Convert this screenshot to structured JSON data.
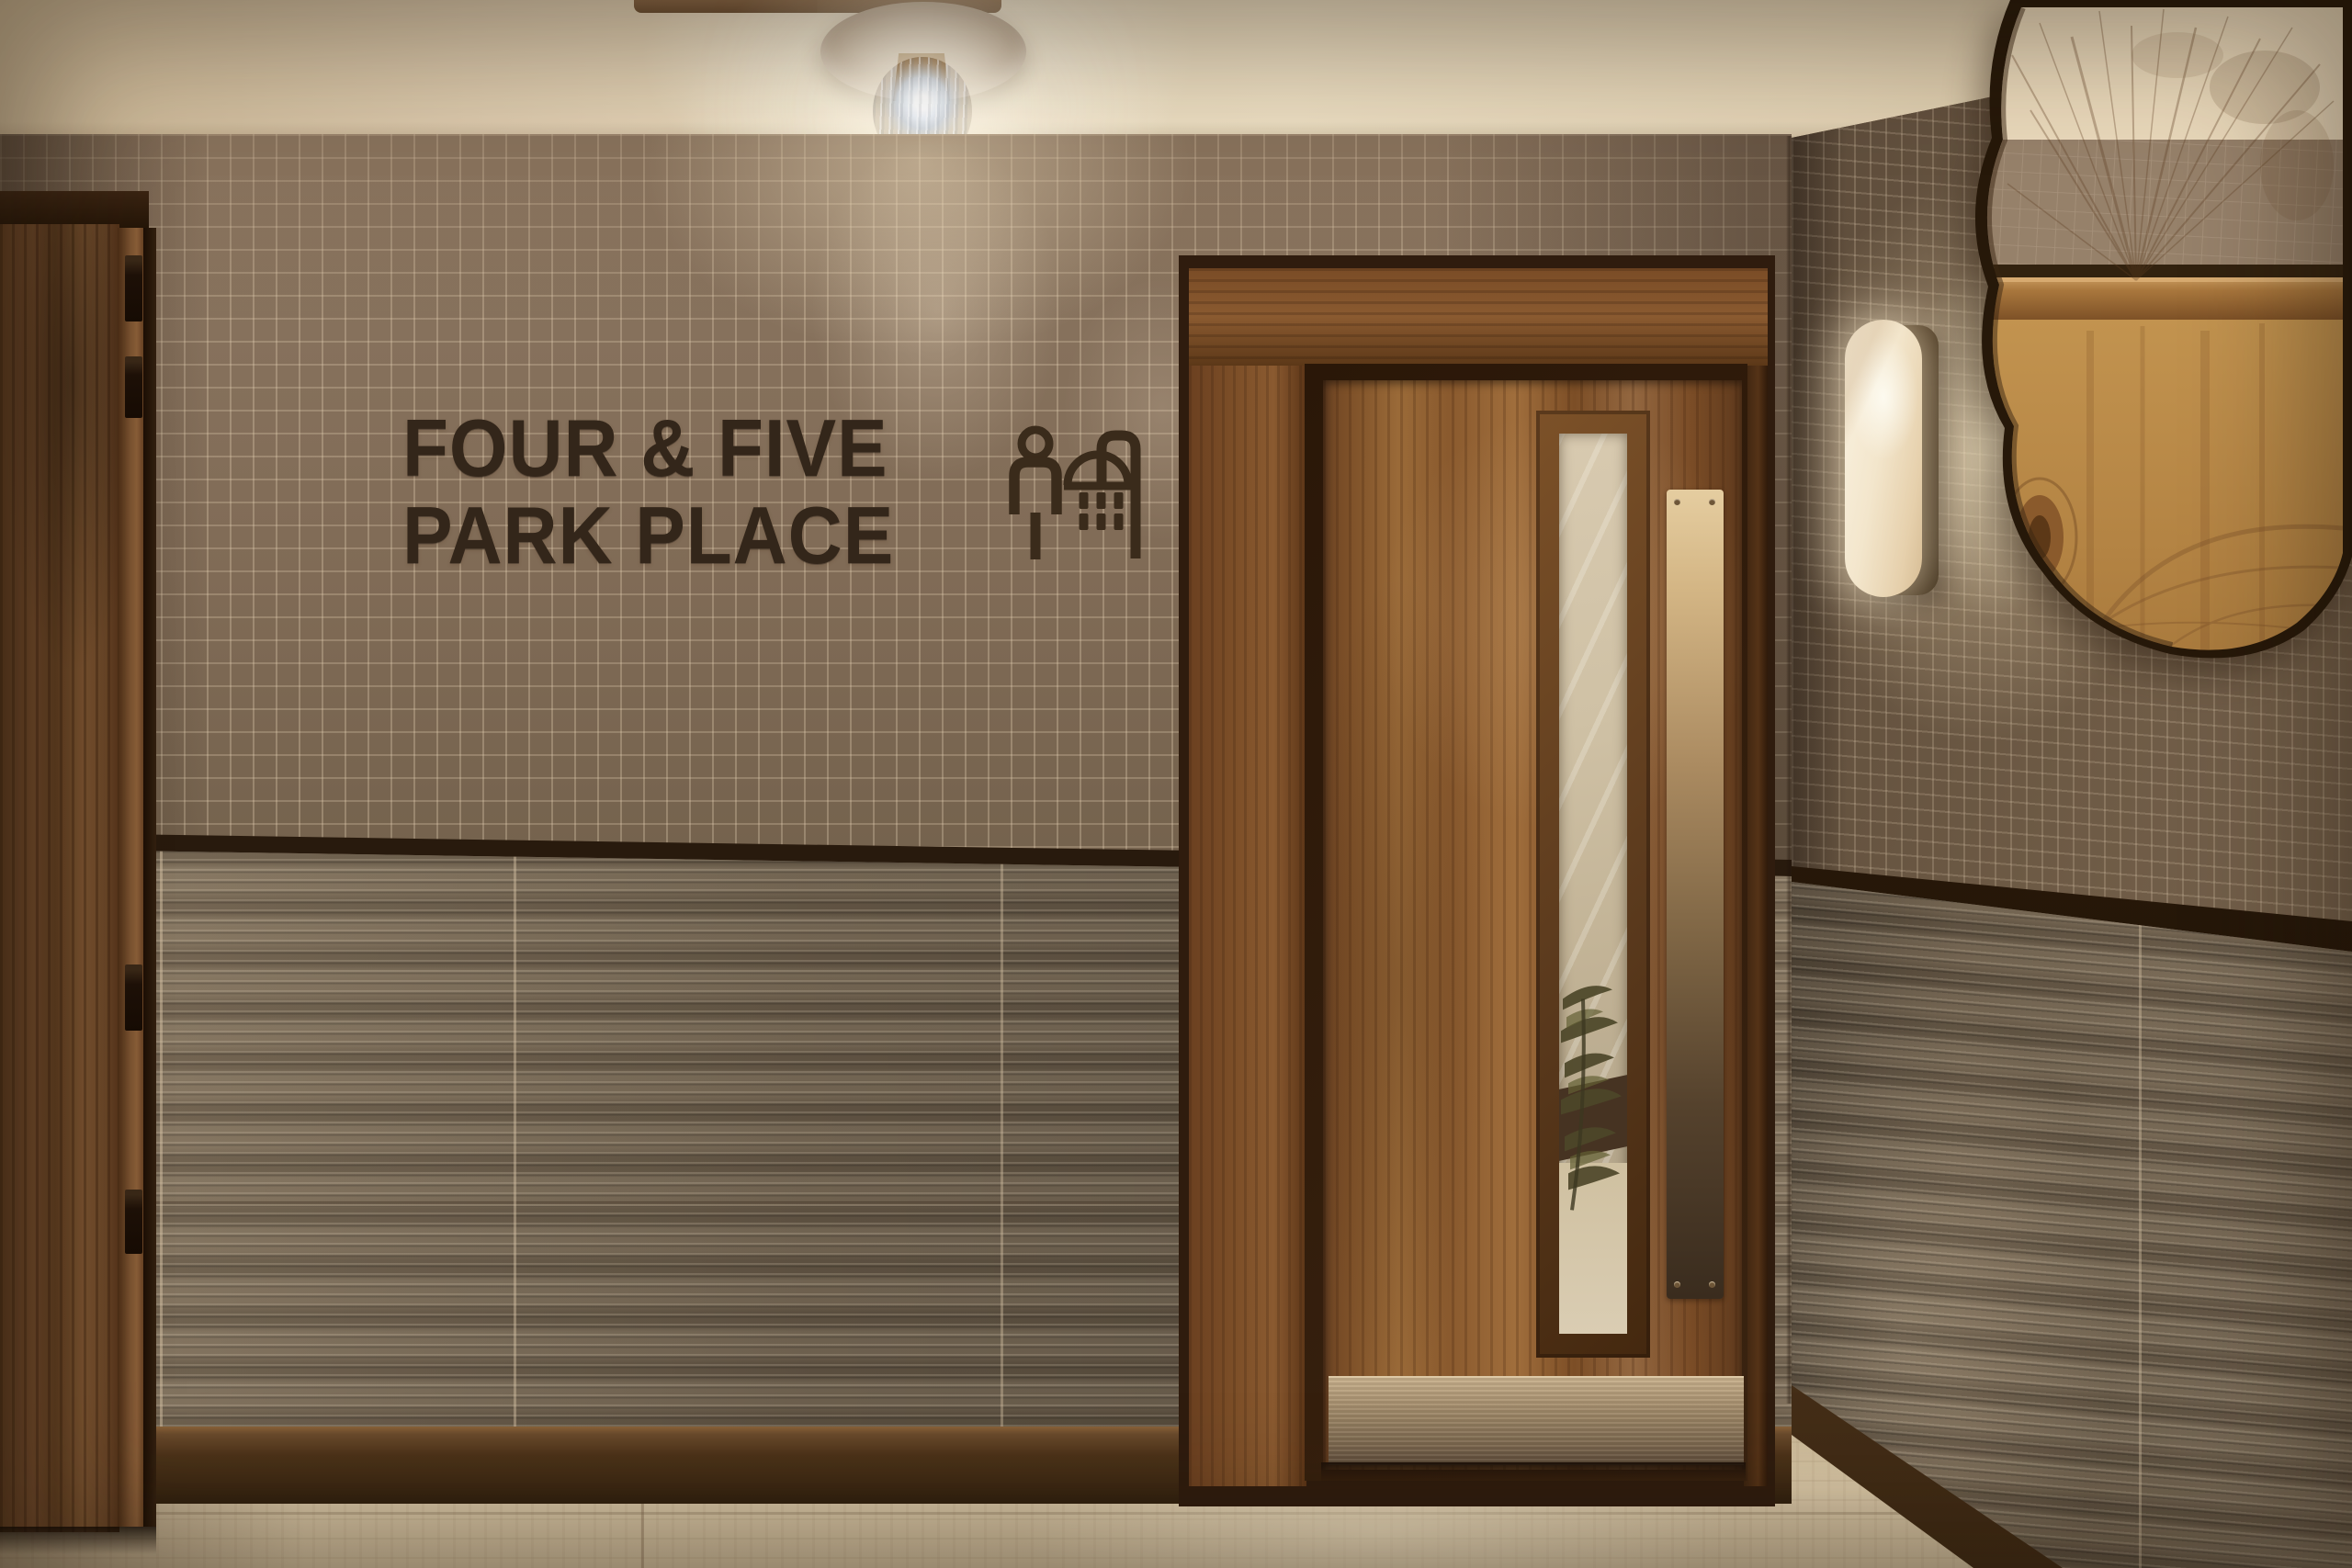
{
  "scene": {
    "type": "interior-photograph",
    "description": "Hotel corridor with mosaic and ridged tiled walls, walnut shower-room door, ceiling globe light, alabaster sconce and live-edge mirror",
    "location_sign": {
      "line1": "FOUR & FIVE",
      "line2": "PARK PLACE"
    },
    "pictograms": [
      "person",
      "shower"
    ]
  },
  "palette": {
    "ceiling": "#e6d7bb",
    "mosaic_tile": "#84705a",
    "grout": "#a99780",
    "ridged_tile": "#7b6b59",
    "dark_trim": "#2a1b0e",
    "walnut_door": "#8a5a2e",
    "door_frame": "#5c3817",
    "sign_text": "#33261a",
    "floor_travertine": "#d3c2a2",
    "metal_plate": "#a18a6a",
    "push_plate_brass": "#d4b685",
    "sconce_glow": "#f6ead2",
    "bulb_light": "#eef3f8"
  }
}
